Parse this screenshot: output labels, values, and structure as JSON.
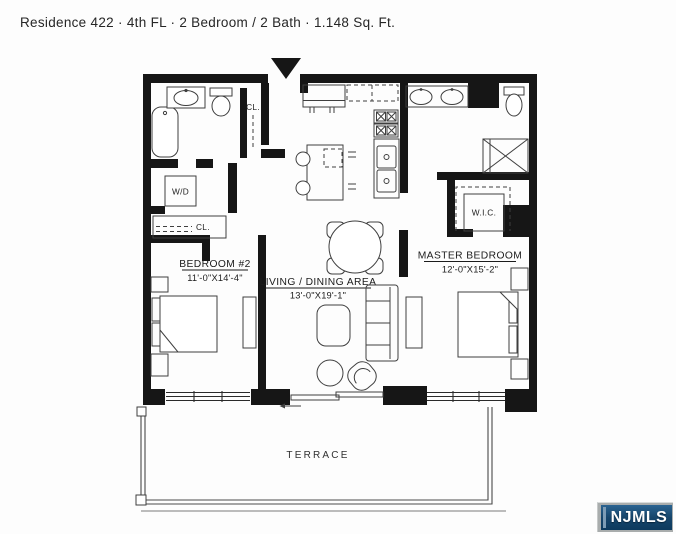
{
  "header": {
    "title": "Residence 422 · 4th FL · 2 Bedroom / 2 Bath · 1.148 Sq. Ft."
  },
  "rooms": {
    "bedroom2": {
      "name": "BEDROOM #2",
      "dims": "11'-0\"X14'-4\""
    },
    "living": {
      "name": "LIVING / DINING AREA",
      "dims": "13'-0\"X19'-1\""
    },
    "master": {
      "name": "MASTER BEDROOM",
      "dims": "12'-0\"X15'-2\""
    },
    "wic": {
      "name": "W.I.C."
    },
    "washer_dryer": {
      "name": "W/D"
    },
    "entry_closet": {
      "name": "CL."
    },
    "bedroom2_closet": {
      "name": "CL."
    },
    "terrace": {
      "name": "TERRACE"
    }
  },
  "fixtures": {
    "bathroom2": [
      "bathtub",
      "vanity-sink",
      "toilet"
    ],
    "master_bathroom": [
      "double-vanity-sink",
      "toilet",
      "shower"
    ],
    "kitchen": [
      "counter",
      "upper-cabinets",
      "stove-burners",
      "double-sink",
      "island",
      "bar-stools"
    ],
    "living_dining": [
      "dining-table",
      "dining-chairs",
      "sofa",
      "coffee-table",
      "ottoman",
      "armchair"
    ],
    "bedroom2": [
      "bed",
      "nightstands",
      "dresser"
    ],
    "master_bedroom": [
      "bed",
      "nightstands",
      "dresser"
    ],
    "other": [
      "entry-arrow",
      "windows",
      "sliding-door",
      "terrace-railing"
    ]
  },
  "watermark": {
    "label": "NJMLS"
  },
  "colors": {
    "wall": "#161616",
    "furniture_line": "#3f3f3f",
    "logo_navy_top": "#2a6391",
    "logo_navy_bottom": "#0d3a5e",
    "logo_text": "#ffffff",
    "logo_stripe": "#7d9cb5"
  }
}
